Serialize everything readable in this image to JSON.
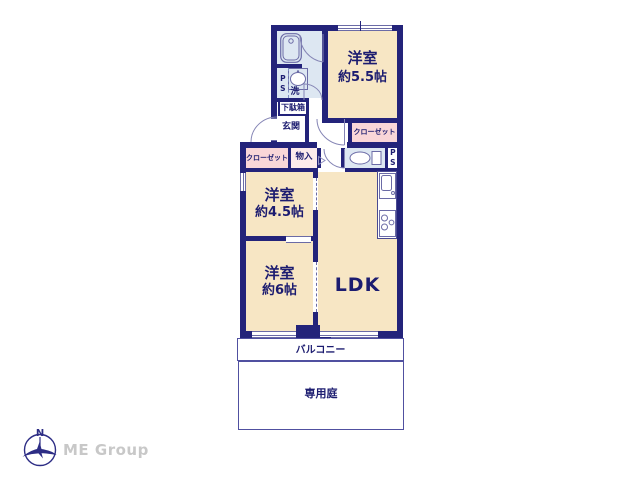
{
  "rooms": {
    "bedroom_5_5": {
      "name": "洋室",
      "size": "約5.5帖"
    },
    "bedroom_4_5": {
      "name": "洋室",
      "size": "約4.5帖"
    },
    "bedroom_6": {
      "name": "洋室",
      "size": "約6帖"
    },
    "ldk": {
      "name": "LDK"
    },
    "entrance": {
      "name": "玄関"
    },
    "balcony": {
      "name": "バルコニー"
    },
    "garden": {
      "name": "専用庭"
    }
  },
  "fixtures": {
    "closet_upper": "クローゼット",
    "closet_lower": "クローゼット",
    "storage": "物入",
    "shoe_cabinet": "下駄箱",
    "laundry": "洗",
    "pipe_space_upper": "PS",
    "pipe_space_lower": "PS"
  },
  "icons": {
    "bathtub": "bathtub-icon",
    "washbasin": "washbasin-icon",
    "toilet": "toilet-icon",
    "kitchen_sink": "kitchen-sink-icon",
    "stove": "stove-icon",
    "door_swing": "door-swing-icon",
    "compass": "compass-icon"
  },
  "colors": {
    "wall": "#23237a",
    "room_fill": "#f7e6c4",
    "closet_fill": "#f9d6d8",
    "storage_fill": "#fcebec",
    "water_fill": "#dde7f2",
    "text": "#1c1c70",
    "logo_gray": "#c8c8c8"
  },
  "branding": {
    "compass_n": "N",
    "logo_text": "ME Group"
  }
}
